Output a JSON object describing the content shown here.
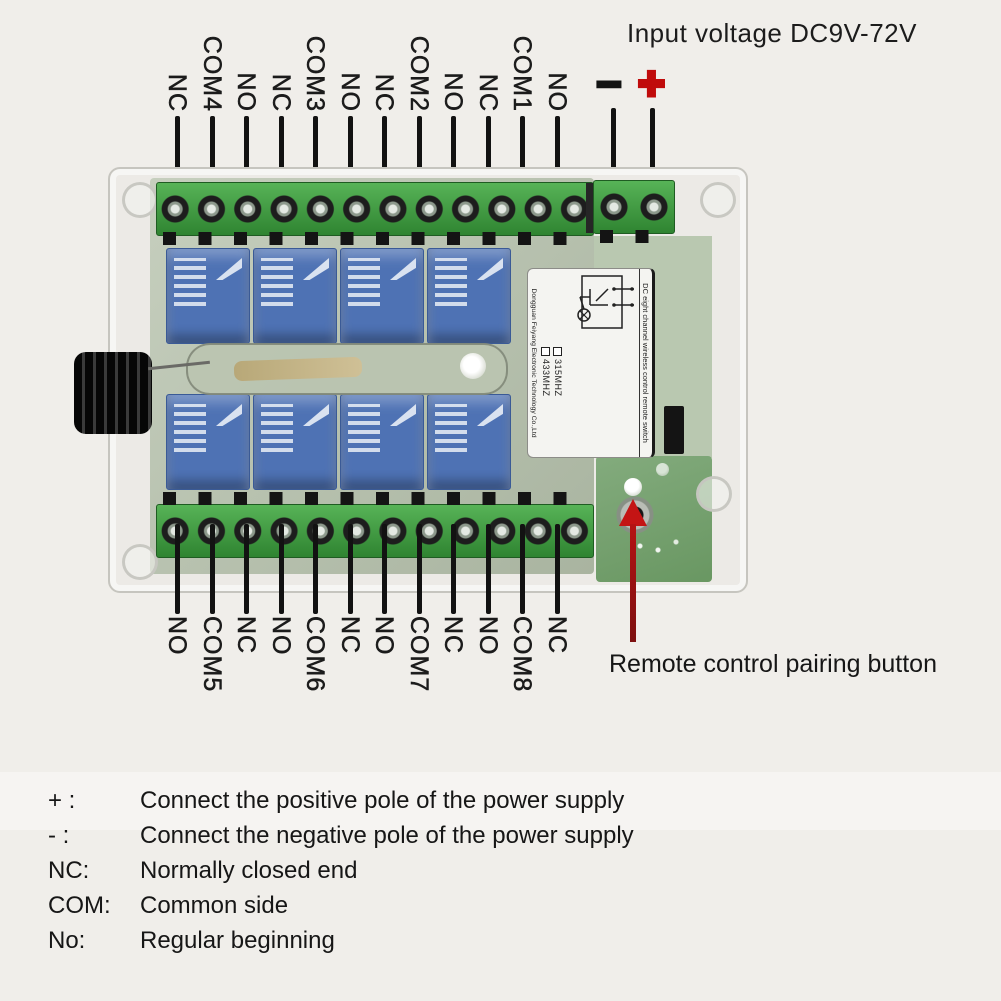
{
  "header": {
    "input_voltage": "Input voltage DC9V-72V"
  },
  "power": {
    "minus": "−",
    "plus": "+"
  },
  "top_terminals": {
    "labels": [
      "NC",
      "COM4",
      "NO",
      "NC",
      "COM3",
      "NO",
      "NC",
      "COM2",
      "NO",
      "NC",
      "COM1",
      "NO"
    ]
  },
  "bottom_terminals": {
    "labels": [
      "NO",
      "COM5",
      "NC",
      "NO",
      "COM6",
      "NC",
      "NO",
      "COM7",
      "NC",
      "NO",
      "COM8",
      "NC"
    ]
  },
  "annotations": {
    "pairing_button": "Remote control pairing button"
  },
  "board_label": {
    "title": "DC eight channel wireless control remote switch",
    "company": "Dongguan Feiyang Electronic Technology Co.,Ltd",
    "frequencies": [
      "315MHZ",
      "433MHZ"
    ]
  },
  "legend": {
    "rows": [
      {
        "key": "+ :",
        "value": "Connect the positive pole of the power supply"
      },
      {
        "key": "- :",
        "value": "Connect the negative pole of the power supply"
      },
      {
        "key": "NC:",
        "value": "Normally closed end"
      },
      {
        "key": "COM:",
        "value": "Common side"
      },
      {
        "key": "No:",
        "value": "Regular beginning"
      }
    ]
  },
  "colors": {
    "accent_red": "#c41414",
    "terminal_green_a": "#57b357",
    "terminal_green_b": "#2f8431",
    "pcb_green": "#7ca577",
    "relay_blue": "#4e72b4",
    "bg": "#f0eeea",
    "text": "#1d1d1d"
  }
}
